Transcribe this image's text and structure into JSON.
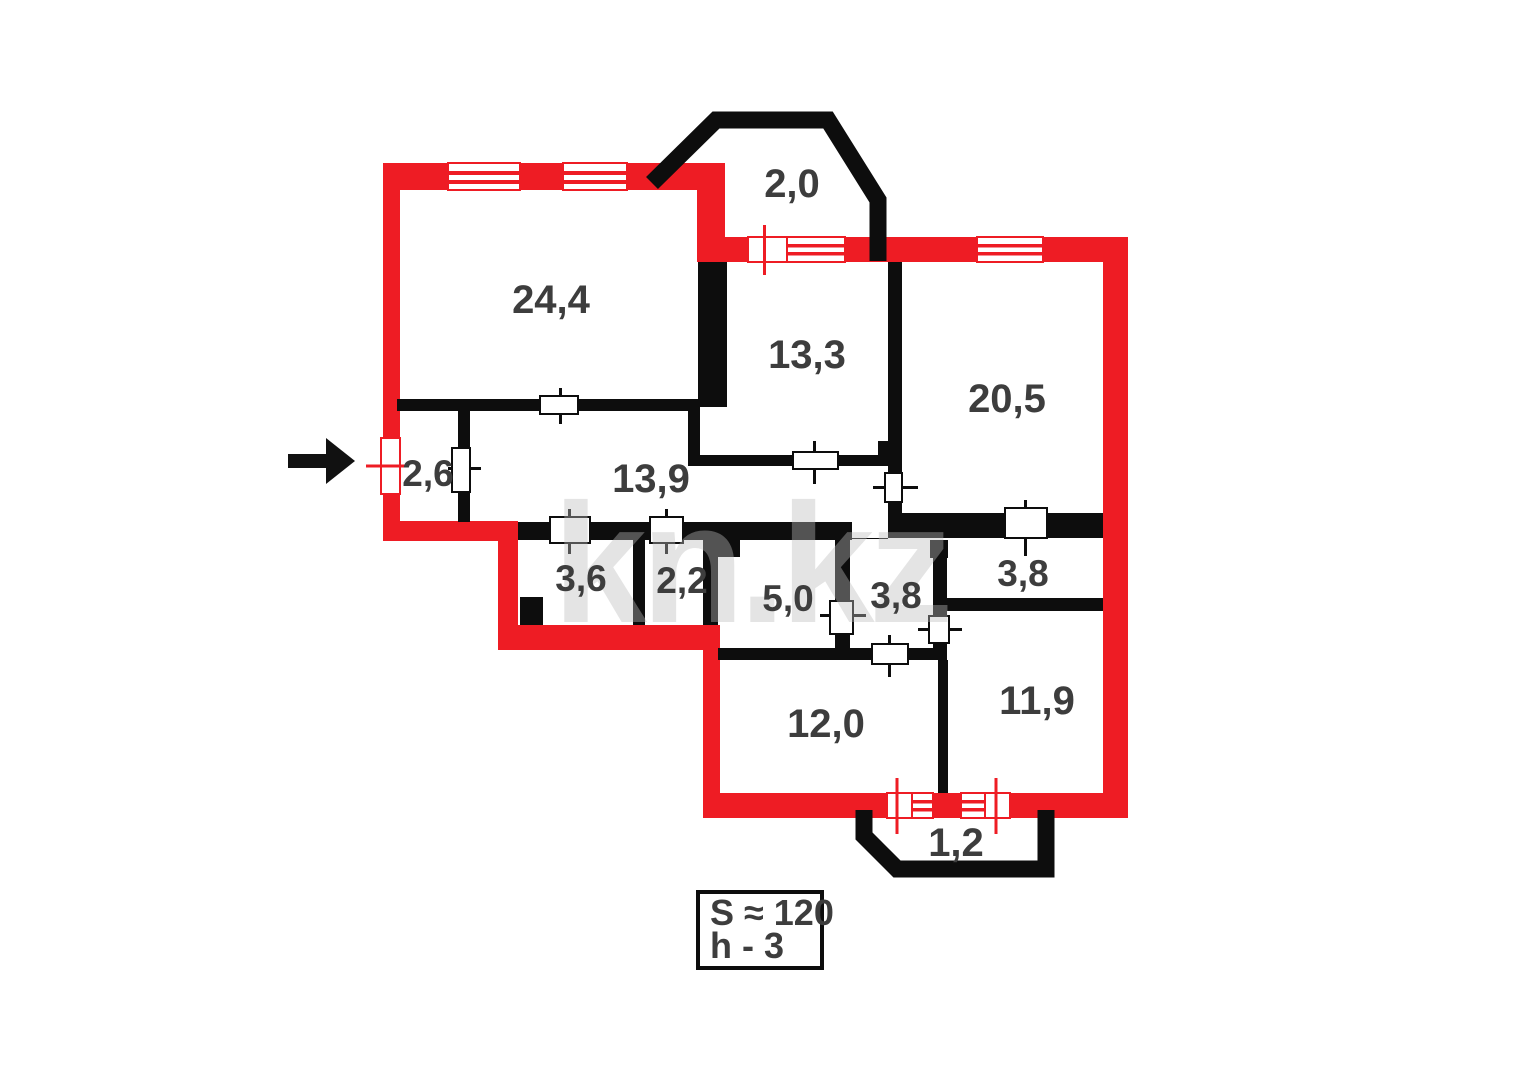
{
  "plan": {
    "title": "apartment-floor-plan",
    "rooms": [
      {
        "name": "living-room",
        "label": "24,4"
      },
      {
        "name": "balcony-top",
        "label": "2,0"
      },
      {
        "name": "room-13-3",
        "label": "13,3"
      },
      {
        "name": "room-20-5",
        "label": "20,5"
      },
      {
        "name": "entry-hall",
        "label": "2,6"
      },
      {
        "name": "corridor",
        "label": "13,9"
      },
      {
        "name": "room-3-6",
        "label": "3,6"
      },
      {
        "name": "room-2-2",
        "label": "2,2"
      },
      {
        "name": "room-5-0",
        "label": "5,0"
      },
      {
        "name": "hall-3-8",
        "label": "3,8"
      },
      {
        "name": "closet-3-8",
        "label": "3,8"
      },
      {
        "name": "room-11-9",
        "label": "11,9"
      },
      {
        "name": "room-12-0",
        "label": "12,0"
      },
      {
        "name": "balcony-bottom",
        "label": "1,2"
      }
    ],
    "legend": {
      "area_label": "S ≈ 120",
      "height_label": "h - 3"
    },
    "watermark": "kn.kz",
    "colors": {
      "exterior_wall": "#ee1c24",
      "interior_wall": "#0d0d0d",
      "label_text": "#3d3d3d",
      "watermark": "#bdbdbd",
      "arrow": "#111111"
    }
  }
}
